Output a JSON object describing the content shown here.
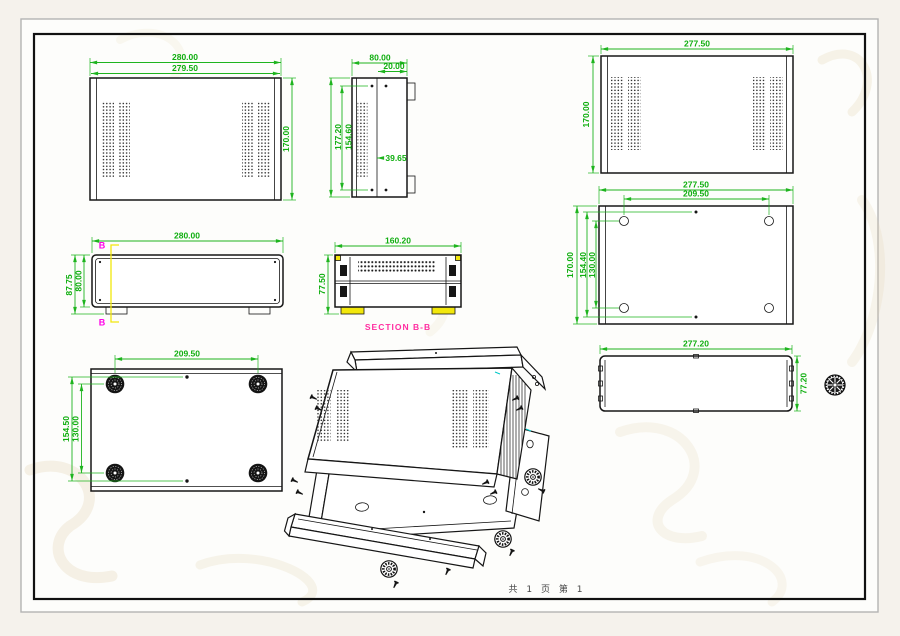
{
  "page": {
    "footer_text": "共 1 页  第 1"
  },
  "colors": {
    "dimension_green": "#1eb41e",
    "section_cut_yellow": "#f2e70c",
    "section_marker_magenta": "#ff00e8",
    "section_title_pink": "#ff2da0",
    "line_black": "#161616",
    "cyan_mark": "#00c8c8",
    "watermark_tan": "#e2d2ab"
  },
  "views": {
    "top_view": {
      "dims": {
        "width_outer": "280.00",
        "width_inner": "279.50",
        "height": "170.00"
      }
    },
    "side_view": {
      "dims": {
        "width": "80.00",
        "inset": "20.00",
        "height_outer": "177.20",
        "height_inner": "154.60",
        "rail": "39.65"
      }
    },
    "cover_view": {
      "dims": {
        "width": "277.50",
        "height": "170.00"
      }
    },
    "base_view": {
      "dims": {
        "width": "277.50",
        "hole_span": "209.50",
        "height": "170.00",
        "hole_height_outer": "154.40",
        "hole_height_inner": "130.00"
      }
    },
    "front_view": {
      "dims": {
        "width": "280.00",
        "height_outer": "87.75",
        "height_inner": "80.00"
      },
      "section_marker": "B"
    },
    "section_view": {
      "dims": {
        "width": "160.20",
        "height": "77.50"
      },
      "title": "SECTION B-B"
    },
    "bottom_view": {
      "dims": {
        "foot_span": "209.50",
        "height_outer": "154.50",
        "height_inner": "130.00"
      }
    },
    "rear_panel_view": {
      "dims": {
        "width": "277.20",
        "height": "77.20"
      }
    }
  }
}
